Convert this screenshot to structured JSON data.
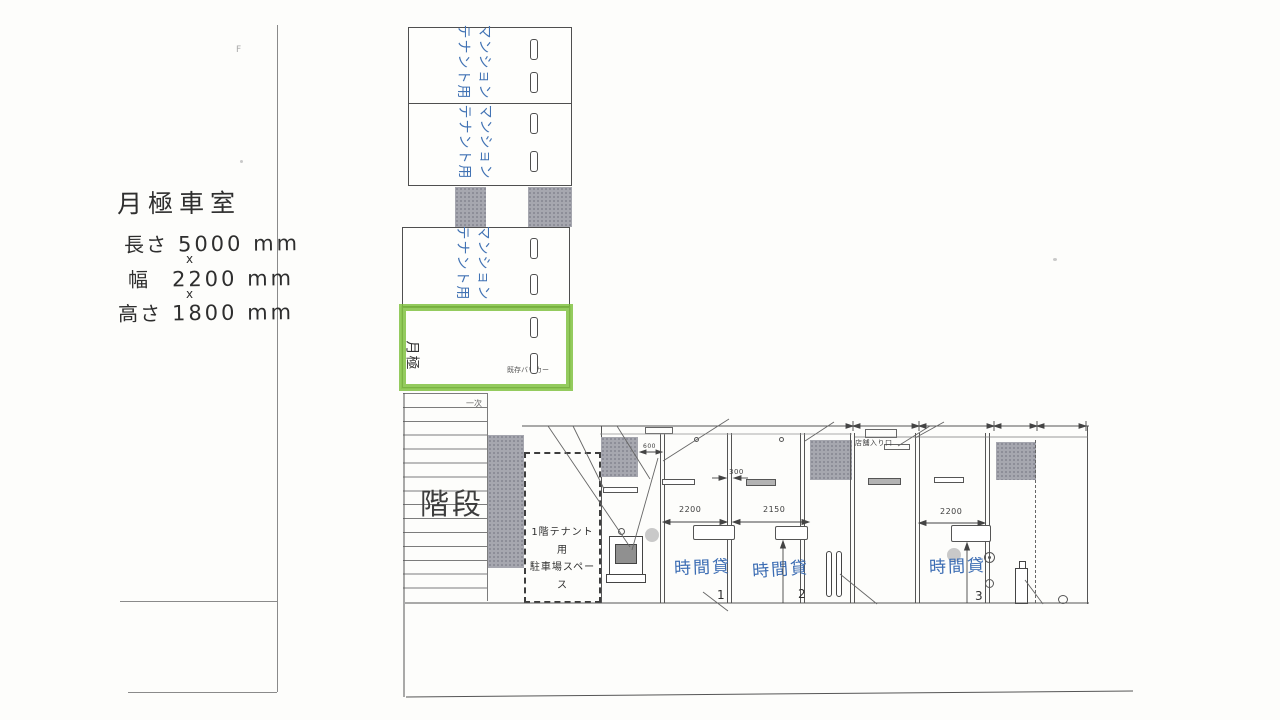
{
  "note": {
    "title": "月極車室",
    "rows": [
      {
        "label": "長さ",
        "value": "5000 mm"
      },
      {
        "label": "幅",
        "value": "2200 mm"
      },
      {
        "label": "高さ",
        "value": "1800 mm"
      }
    ],
    "times": "x",
    "corner_mark": "F"
  },
  "upper_parking": {
    "stalls": [
      {
        "label": "マンション\nテナント用"
      },
      {
        "label": "マンション\nテナント用"
      },
      {
        "label": "マンション\nテナント用"
      },
      {
        "label": "月極",
        "note": "既存バリカー",
        "highlighted": true
      }
    ]
  },
  "site": {
    "stairs_label": "階段",
    "small_mark": "一次",
    "tenant_space": "1階テナント用\n駐車場スペース",
    "entrance": "店舗入り口"
  },
  "lower_parking": {
    "stalls": [
      {
        "name": "時間貸",
        "number": "1",
        "dim": "2200"
      },
      {
        "name": "時間貸",
        "number": "2",
        "dim": "2150"
      },
      {
        "name": "時間貸",
        "number": "3",
        "dim": "2200"
      }
    ],
    "gap_dim": "300",
    "pillar_dim": "600"
  },
  "colors": {
    "paper": "#fdfdfb",
    "ink": "#555555",
    "handwriting_blue": "#3b6cb3",
    "highlight_green": "#7cbf3a",
    "pillar_gray": "#a6a7af"
  }
}
